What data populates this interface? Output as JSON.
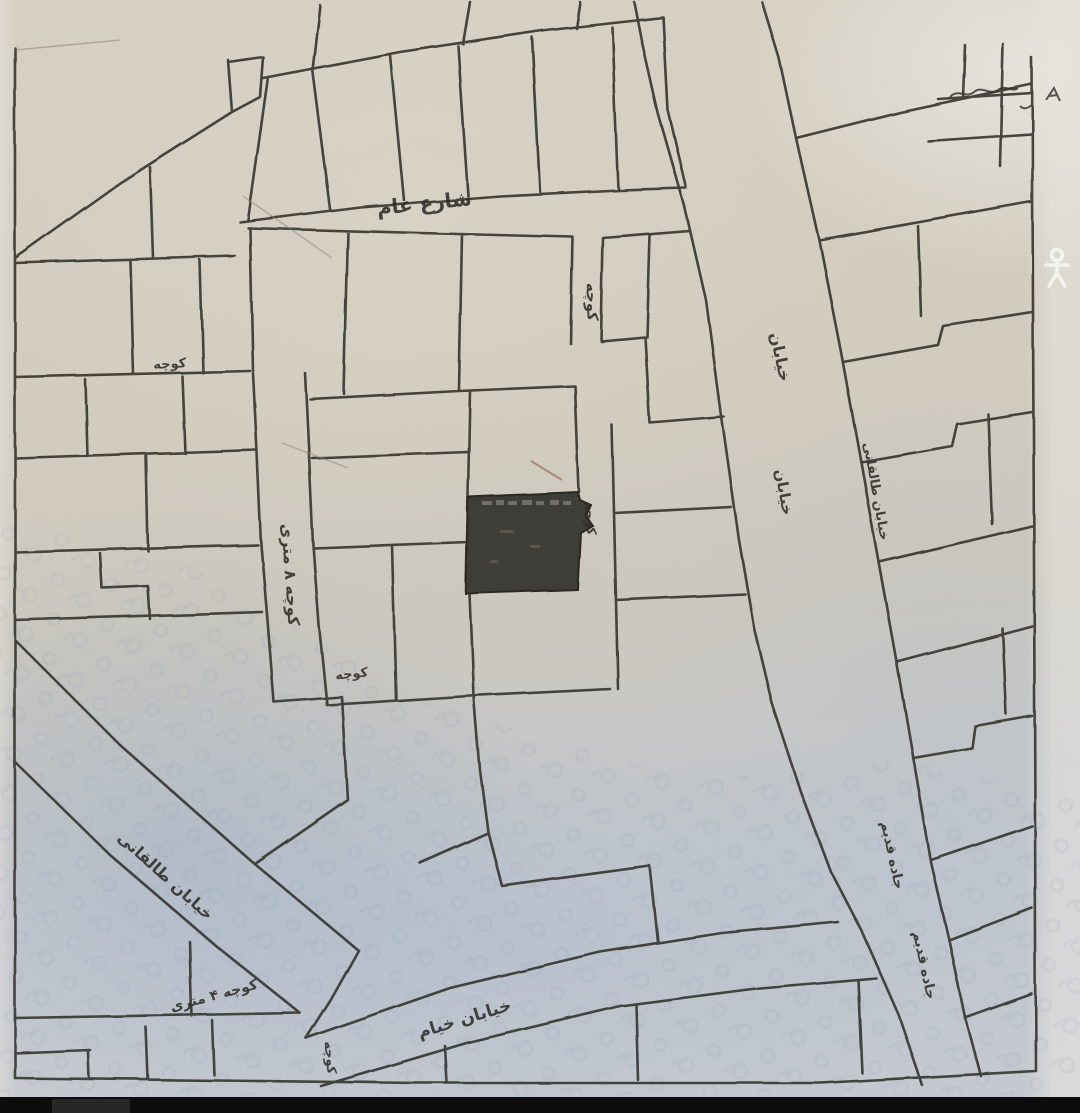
{
  "map": {
    "kind": "scanned hand-drawn cadastral parcel plan",
    "street_labels": {
      "public_street": "شارع عام",
      "alley_top": "کوچه",
      "street_right_upper": "خیابان",
      "street_right_mid": "خیابان",
      "alley_center": "کوچه",
      "alley_8m": "کوچه ۸ متری",
      "alley_left_small": "کوچه",
      "alley_mid_small": "کوچه",
      "taleghani_street": "خیابان طالقانی",
      "taleghani_right": "خیابان طالقانی",
      "alley_4m": "کوچه ۴ متری",
      "khayyam_street": "خیابان خیام",
      "alley_bottom": "کوچه",
      "jadeh_upper": "جاده قدیم",
      "jadeh_lower": "جاده قدیم"
    },
    "colors": {
      "paper": "#d2ccc0",
      "paper_blue_tint": "#c3cdd8",
      "ink": "#33312c",
      "highlighted_parcel_fill": "#3b3a36",
      "crease": "#a06a52",
      "footer_bar": "#0c0c0c"
    },
    "icons": {
      "pegman": "person-icon"
    }
  }
}
